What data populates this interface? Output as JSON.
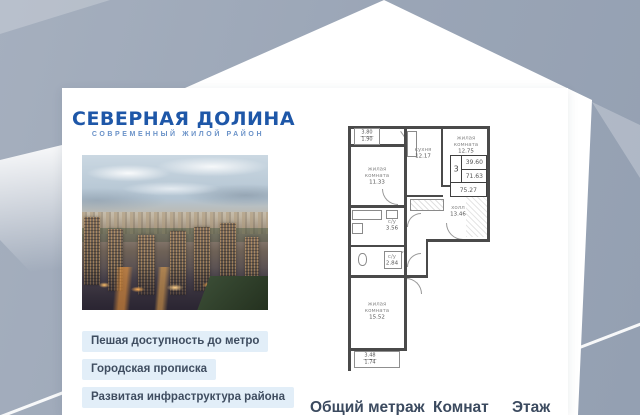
{
  "brand": {
    "name": "СЕВЕРНАЯ ДОЛИНА",
    "tagline": "СОВРЕМЕННЫЙ ЖИЛОЙ РАЙОН"
  },
  "features": [
    {
      "label": "Пешая доступность до метро"
    },
    {
      "label": "Городская прописка"
    },
    {
      "label": "Развитая инфраструктура района"
    }
  ],
  "floorplan": {
    "rooms": [
      {
        "name": "жилая комната",
        "area": "11.33"
      },
      {
        "name": "кухня",
        "area": "12.17"
      },
      {
        "name": "жилая комната",
        "area": "12.75"
      },
      {
        "name": "холл",
        "area": "13.46"
      },
      {
        "name": "с/у",
        "area": "3.56"
      },
      {
        "name": "с/у",
        "area": "2.84"
      },
      {
        "name": "жилая комната",
        "area": "15.52"
      }
    ],
    "balcony_top": {
      "a": "3.80",
      "b": "1.90"
    },
    "balcony_bottom": {
      "a": "3.48",
      "b": "1.74"
    },
    "summary": {
      "rooms_count": "3",
      "area_living": "39.60",
      "area_mid": "71.63",
      "area_total": "75.27"
    }
  },
  "footer": {
    "total_label": "Общий метраж",
    "rooms_label": "Комнат",
    "floor_label": "Этаж"
  },
  "colors": {
    "brand_blue": "#1e57a8",
    "badge_bg": "#e2eef8",
    "background_gray_blue": "#9fa9b9"
  }
}
